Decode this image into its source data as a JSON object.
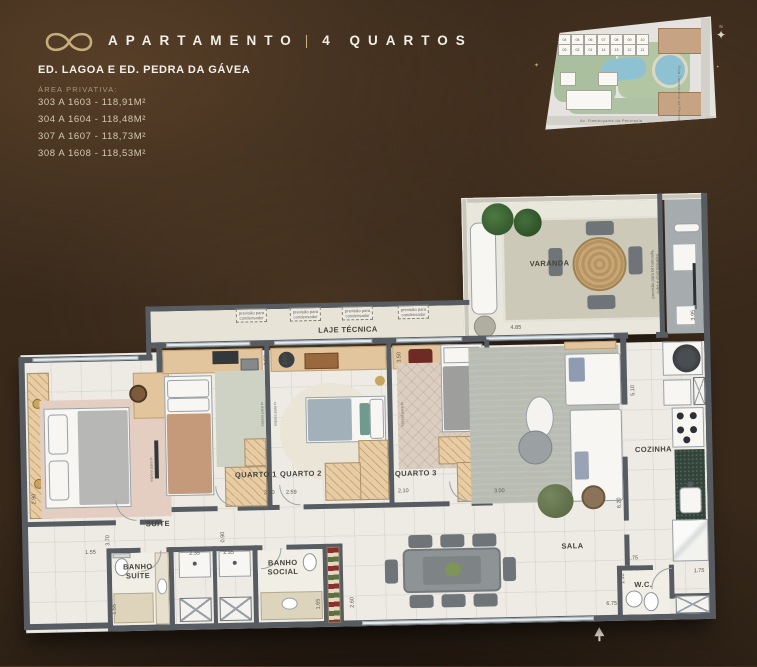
{
  "header": {
    "logo_icon": "infinity-logo",
    "title_left": "APARTAMENTO",
    "title_divider": "|",
    "title_right": "4 QUARTOS",
    "subtitle": "ED. LAGOA E ED. PEDRA DA GÁVEA",
    "area_label": "ÁREA PRIVATIVA:",
    "areas": [
      "303 A 1603 - 118,91M²",
      "304 A 1604 - 118,48M²",
      "307 A 1607 - 118,73M²",
      "308 A 1608 - 118,53M²"
    ]
  },
  "sitemap": {
    "north_label": "N",
    "street_bottom": "Av. Flamboyants da Península",
    "street_right": "Rua Tamarindos da Península",
    "unit_rows": [
      [
        "04",
        "05",
        "06",
        "07",
        "08",
        "09",
        "10"
      ],
      [
        "03",
        "02",
        "01",
        "14",
        "13",
        "12",
        "11"
      ]
    ]
  },
  "plan": {
    "rooms": [
      {
        "label": "VARANDA",
        "x": 535,
        "y": 68
      },
      {
        "label": "LAJE TÉCNICA",
        "x": 332,
        "y": 130
      },
      {
        "label": "QUARTO 1",
        "x": 237,
        "y": 273
      },
      {
        "label": "QUARTO 2",
        "x": 282,
        "y": 273
      },
      {
        "label": "QUARTO 3",
        "x": 397,
        "y": 275
      },
      {
        "label": "SUÍTE",
        "x": 138,
        "y": 320
      },
      {
        "label": "BANHO\nSUÍTE",
        "x": 117,
        "y": 367
      },
      {
        "label": "BANHO\nSOCIAL",
        "x": 262,
        "y": 366
      },
      {
        "label": "SALA",
        "x": 552,
        "y": 351
      },
      {
        "label": "COZINHA",
        "x": 635,
        "y": 256
      },
      {
        "label": "W.C.",
        "x": 622,
        "y": 391
      }
    ],
    "notes": [
      {
        "text": "previsão para\ncondensador",
        "x": 236,
        "y": 113,
        "box": true
      },
      {
        "text": "previsão para\ncondensador",
        "x": 290,
        "y": 113,
        "box": true
      },
      {
        "text": "previsão para\ncondensador",
        "x": 342,
        "y": 113,
        "box": true
      },
      {
        "text": "previsão para\ncondensador",
        "x": 398,
        "y": 113,
        "box": true
      },
      {
        "text": "previsão para kit bancada,\ncuba e churrasqueira",
        "x": 640,
        "y": 80,
        "rot": true
      },
      {
        "text": "espera para tv",
        "x": 245,
        "y": 212,
        "rot": true
      },
      {
        "text": "espera para tv",
        "x": 258,
        "y": 212,
        "rot": true
      },
      {
        "text": "espera para tv",
        "x": 133,
        "y": 265,
        "rot": true
      },
      {
        "text": "espera para tv",
        "x": 385,
        "y": 215,
        "rot": true
      }
    ],
    "dims": [
      {
        "v": "4.85",
        "x": 500,
        "y": 131
      },
      {
        "v": "3.95",
        "x": 678,
        "y": 122,
        "rot": true
      },
      {
        "v": "3.50",
        "x": 250,
        "y": 158,
        "rot": true
      },
      {
        "v": "3.50",
        "x": 269,
        "y": 158,
        "rot": true
      },
      {
        "v": "3.50",
        "x": 383,
        "y": 158,
        "rot": true
      },
      {
        "v": "2.50",
        "x": 250,
        "y": 291
      },
      {
        "v": "2.59",
        "x": 272,
        "y": 291
      },
      {
        "v": "2.10",
        "x": 384,
        "y": 292
      },
      {
        "v": "3.00",
        "x": 480,
        "y": 294
      },
      {
        "v": "5.10",
        "x": 616,
        "y": 196,
        "rot": true
      },
      {
        "v": "6.20",
        "x": 600,
        "y": 308,
        "rot": true
      },
      {
        "v": "2.90",
        "x": 15,
        "y": 292,
        "rot": true
      },
      {
        "v": "1.55",
        "x": 70,
        "y": 347
      },
      {
        "v": "3.70",
        "x": 88,
        "y": 335,
        "rot": true
      },
      {
        "v": "0.90",
        "x": 203,
        "y": 334,
        "rot": true
      },
      {
        "v": "2.35",
        "x": 174,
        "y": 350
      },
      {
        "v": "2.35",
        "x": 208,
        "y": 350
      },
      {
        "v": "1.55",
        "x": 93,
        "y": 404,
        "rot": true
      },
      {
        "v": "1.65",
        "x": 297,
        "y": 403,
        "rot": true
      },
      {
        "v": "2.60",
        "x": 331,
        "y": 402,
        "rot": true
      },
      {
        "v": "6.75",
        "x": 590,
        "y": 409
      },
      {
        "v": "1.75",
        "x": 612,
        "y": 364
      },
      {
        "v": "1.10",
        "x": 602,
        "y": 384,
        "rot": true
      },
      {
        "v": "1.75",
        "x": 678,
        "y": 378
      }
    ]
  }
}
